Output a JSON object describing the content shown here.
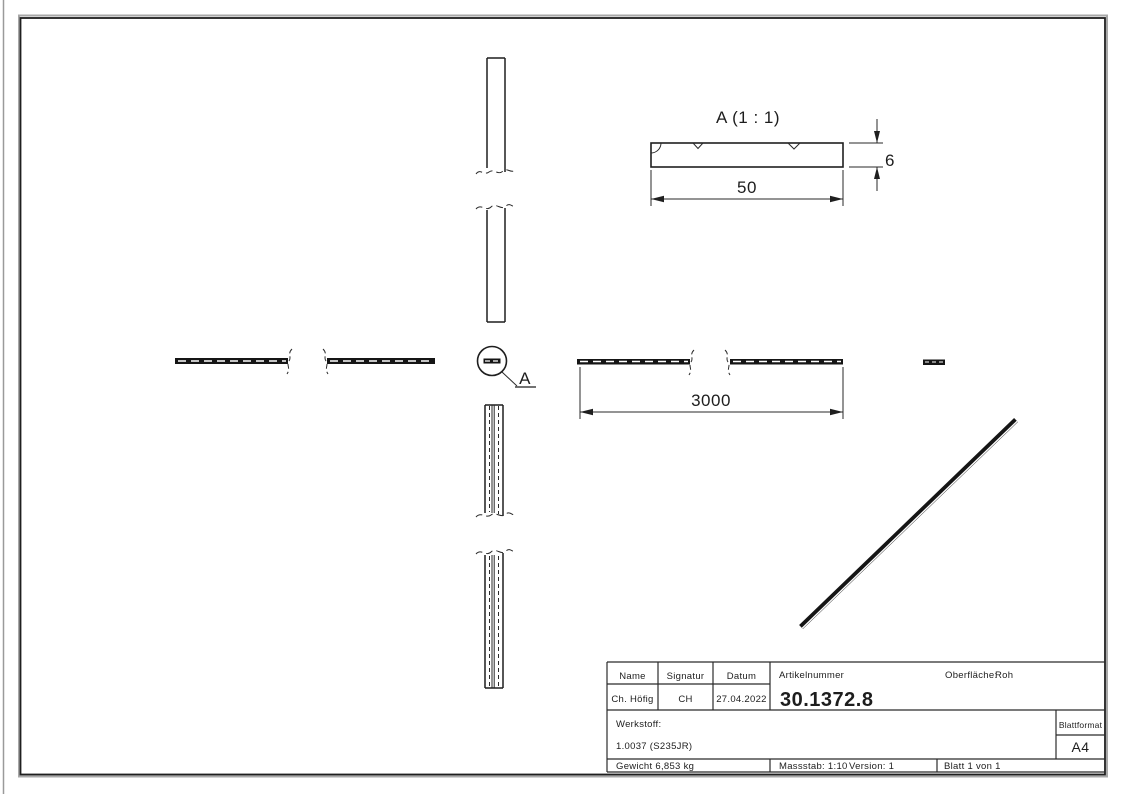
{
  "annotations": {
    "detail_title": "A (1 : 1)",
    "detail_letter": "A",
    "dim_length": "3000",
    "dim_width": "50",
    "dim_thickness": "6"
  },
  "title_block": {
    "headers": {
      "name": "Name",
      "signature": "Signatur",
      "date": "Datum",
      "article": "Artikelnummer",
      "surface_label": "Oberfläche:",
      "surface_value": "Roh"
    },
    "values": {
      "name": "Ch. Höfig",
      "signature": "CH",
      "date": "27.04.2022",
      "article_number": "30.1372.8"
    },
    "material_label": "Werkstoff:",
    "material_value": "1.0037 (S235JR)",
    "weight": "Gewicht 6,853 kg",
    "scale": "Massstab: 1:10",
    "version": "Version: 1",
    "sheet": "Blatt 1 von 1",
    "format_label": "Blattformat",
    "format_value": "A4"
  },
  "colors": {
    "line": "#1f1f1f",
    "shadow": "#a8a8a8",
    "paper": "#ffffff"
  }
}
